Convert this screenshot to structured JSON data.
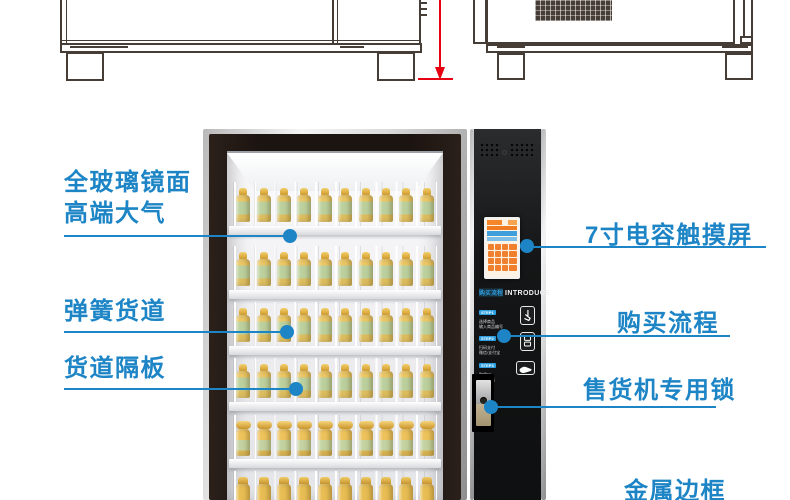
{
  "accent_blue": "#1d85c6",
  "dimension_red": "#e60012",
  "frame_dark": "#1c1411",
  "callouts": {
    "glass_mirror": {
      "line1": "全玻璃镜面",
      "line2": "高端大气"
    },
    "spring_lane": {
      "label": "弹簧货道"
    },
    "lane_divider": {
      "label": "货道隔板"
    },
    "touchscreen": {
      "label": "7寸电容触摸屏"
    },
    "purchase_flow": {
      "label": "购买流程"
    },
    "vending_lock": {
      "label": "售货机专用锁"
    },
    "metal_frame": {
      "label": "金属边框"
    }
  },
  "panel": {
    "intro_cn": "购买流程",
    "intro_en": "INTRODUCE",
    "steps": [
      {
        "tag": "STEP1",
        "line1": "选择商品",
        "line2": "输入商品编号",
        "icon": "touch-screen-icon"
      },
      {
        "tag": "STEP2",
        "line1": "扫码支付",
        "line2": "微信/支付宝",
        "icon": "scan-pay-icon"
      },
      {
        "tag": "STEP3",
        "line1": "取货口",
        "line2": "取出商品",
        "icon": "take-goods-icon"
      }
    ]
  },
  "machine": {
    "shelf_rows": 6,
    "bottles_per_row": 10
  }
}
